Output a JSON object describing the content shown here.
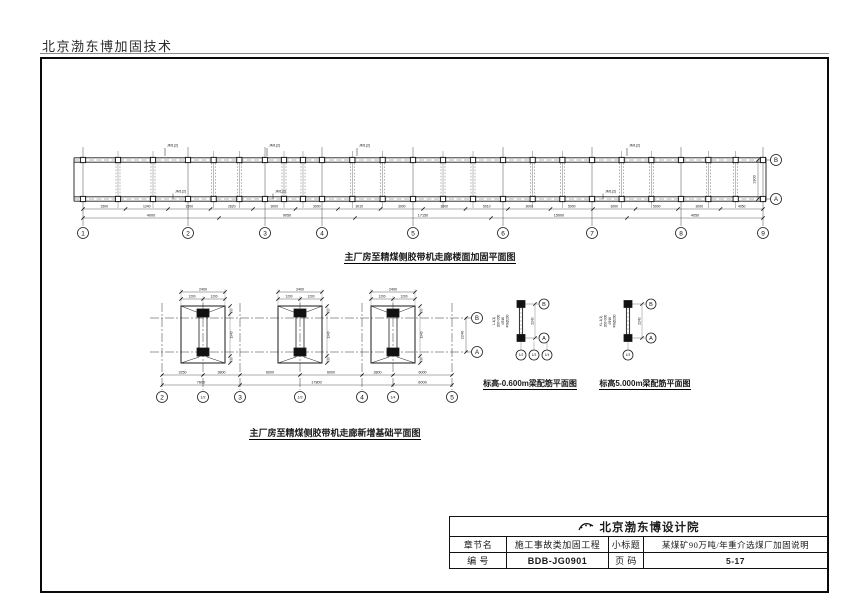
{
  "page": {
    "header": "北京渤东博加固技术"
  },
  "plan1": {
    "title": "主厂房至精煤侧胶带机走廊楼面加固平面图",
    "grid_bubbles": [
      "1",
      "2",
      "3",
      "4",
      "5",
      "6",
      "7",
      "8",
      "9"
    ],
    "right_bubbles": [
      "B",
      "A"
    ],
    "right_dim": "1900",
    "top_annotations": [
      "JM1(2)",
      "JM1(2)",
      "JM1(2)",
      "JM1(2)"
    ],
    "bottom_annotations": [
      "JM1(2)",
      "JM1(2)",
      "JM1(2)"
    ],
    "dims_row1": [
      "1500",
      "1240",
      "1500",
      "2620",
      "3000",
      "3000",
      "3010",
      "3000",
      "3000",
      "5010",
      "3000",
      "5000",
      "3000",
      "5000",
      "3000",
      "4050"
    ],
    "dims_row2": [
      "4000",
      "9050",
      "17150",
      "15000",
      "4050"
    ]
  },
  "plan2": {
    "title": "主厂房至精煤侧胶带机走廊新增基础平面图",
    "grid_bubbles": [
      "2",
      "1/2",
      "3",
      "1/3",
      "4",
      "1/4",
      "5"
    ],
    "right_bubbles": [
      "B",
      "A"
    ],
    "right_dim": "2240",
    "pad_top_dim": "2400",
    "pad_split_left": "1200",
    "pad_split_right": "1200",
    "pad_side_dims": [
      "150",
      "1940",
      "150"
    ],
    "dims_row1": [
      "3250",
      "3800",
      "6000",
      "6000",
      "3800",
      "6000"
    ],
    "dims_row2": [
      "7600",
      "17800",
      "6000"
    ]
  },
  "detail1": {
    "title": "标高-0.600m梁配筋平面图",
    "beam_text": [
      "L-1(1)",
      "200×300",
      "4Φ16",
      "Φ8@200"
    ],
    "right_bubbles": [
      "B",
      "A"
    ],
    "dim": "2240",
    "bottom_bubbles": [
      "1/2",
      "1/3",
      "1/4"
    ]
  },
  "detail2": {
    "title": "标高5.000m梁配筋平面图",
    "beam_text": [
      "XL-1(1)",
      "200×300",
      "4Φ16",
      "Φ8@200"
    ],
    "right_bubbles": [
      "B",
      "A"
    ],
    "dim": "2240",
    "bottom_bubbles": [
      "1/3"
    ]
  },
  "titleblock": {
    "company": "北京渤东博设计院",
    "row1": {
      "c1": "章节名",
      "c2": "施工事故类加固工程",
      "c3": "小标题",
      "c4": "某煤矿90万吨/年重介选煤厂加固说明"
    },
    "row2": {
      "c1": "编  号",
      "c2": "BDB-JG0901",
      "c3": "页  码",
      "c4": "5-17"
    }
  },
  "colors": {
    "line": "#1a1a1a",
    "bg": "#ffffff"
  }
}
